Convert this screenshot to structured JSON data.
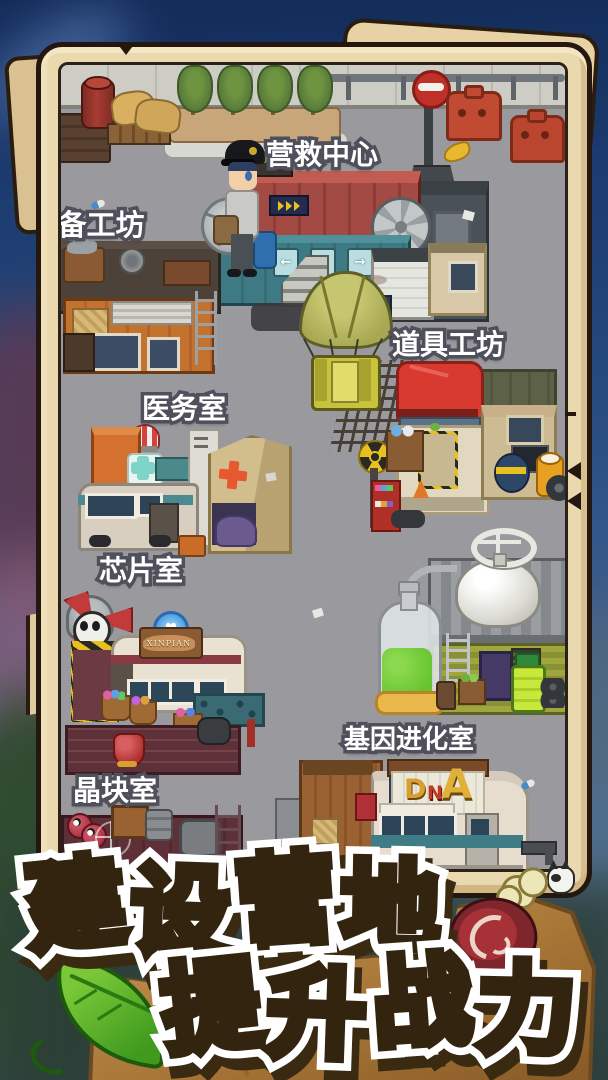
{
  "game": {
    "labels": {
      "rescue_center": "营救中心",
      "equipment_workshop": "备工坊",
      "prop_workshop": "道具工坊",
      "medical_room": "医务室",
      "chip_room": "芯片室",
      "crystal_room": "晶块室",
      "gene_evolution_room": "基因进化室"
    },
    "signs": {
      "chip_van": "XINPIAN",
      "dna": [
        "D",
        "N",
        "A"
      ],
      "direction_arrows": [
        "←",
        "↑",
        "→",
        "↓"
      ],
      "heart": "♥"
    },
    "banner": {
      "line1": "建设营地",
      "line1_chars": [
        "建",
        "设",
        "营",
        "地"
      ],
      "line2": "提升战力",
      "line2_chars": [
        "提",
        "升",
        "战",
        "力"
      ]
    },
    "colors": {
      "sky": "#1c3a6e",
      "parchment": "#ead8ae",
      "ground": "#9a9a9e",
      "banner_green": "#6cc41a",
      "banner_yellow": "#f2e60a",
      "tarp_red": "#d83a30",
      "container_teal": "#3f7c85",
      "label_outline": "#50505c"
    }
  }
}
